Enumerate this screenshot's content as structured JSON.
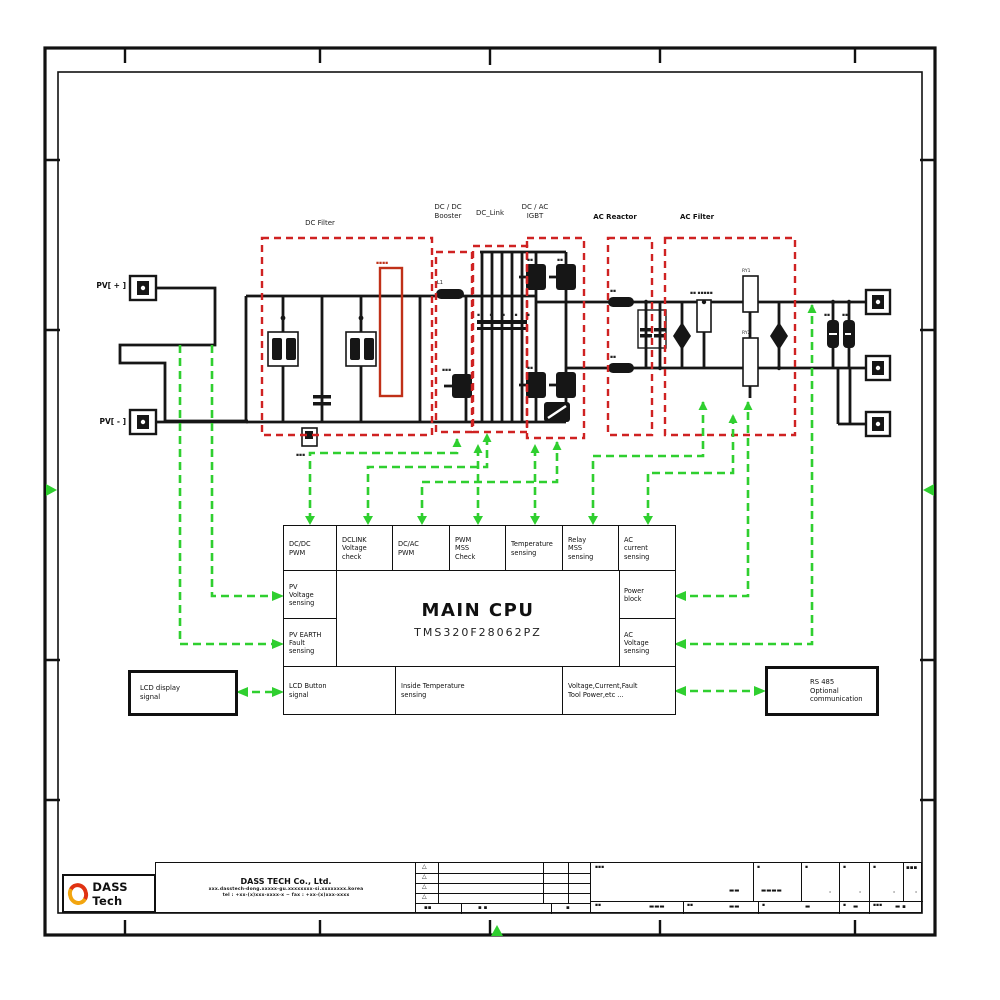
{
  "colors": {
    "wire_black": "#161616",
    "control_green": "#2fcf2f",
    "section_red": "#cf2222",
    "logo_red": "#e03212",
    "logo_orange": "#f2a50f"
  },
  "pv": {
    "plus": "PV[ + ]",
    "minus": "PV[ - ]"
  },
  "sec": {
    "dc_filter": "DC Filter",
    "booster": "DC / DC\nBooster",
    "dc_link": "DC_Link",
    "igbt": "DC / AC\nIGBT",
    "ac_reactor": "AC Reactor",
    "ac_filter": "AC Filter"
  },
  "cpu": {
    "title": "MAIN CPU",
    "part": "TMS320F28062PZ",
    "top": [
      "DC/DC\nPWM",
      "DCLINK\nVoltage\ncheck",
      "DC/AC\nPWM",
      "PWM\nMSS\nCheck",
      "Temperature\nsensing",
      "Relay\nMSS\nsensing",
      "AC\ncurrent\nsensing"
    ],
    "left": [
      "PV\nVoltage\nsensing",
      "PV EARTH\nFault\nsensing"
    ],
    "right": [
      "Power\nblock",
      "AC\nVoltage\nsensing"
    ],
    "bottom": [
      "LCD Button\nsignal",
      "Inside Temperature\nsensing",
      "Voltage,Current,Fault\nTool Power,etc ..."
    ]
  },
  "ext": {
    "lcd": "LCD display\nsignal",
    "rs485": "RS 485\nOptional\ncommunication"
  },
  "comp": {
    "l1": "L1",
    "ry1": "RY1",
    "ry2": "RY2",
    "red_mark": "▪▪▪▪",
    "caps_row": "▪ ▪ ▪ ▪ ▪",
    "film_label": "▪▪ ▪▪▪▪▪",
    "mark2": "▪▪",
    "mark3": "▪▪▪",
    "igbt_mark": "▪▪"
  },
  "tb": {
    "logo": "DASS Tech",
    "name": "DASS TECH Co., Ltd.",
    "addr": "xxx.dasstech-dong.xxxxx-gu.xxxxxxxx-si.xxxxxxxx.korea",
    "tel": "tel : +xx-(x)xxx-xxxx-x  ~  fax : +xx-(x)xxx-xxxx",
    "tri": "△",
    "foot": [
      "▪▪",
      "▪ ▪",
      "▪"
    ],
    "r1": [
      {
        "k": "▪▪▪",
        "v": "▬▬"
      },
      {
        "k": "▪",
        "v": "▬▬▬▬"
      },
      {
        "k": "▪",
        "v": "·"
      },
      {
        "k": "▪",
        "v": "·"
      },
      {
        "k": "▪",
        "v": "·"
      },
      {
        "k": "▪▪▪",
        "v": "·"
      }
    ],
    "r2": [
      {
        "k": "▪▪",
        "v": "▬▬▬"
      },
      {
        "k": "▪▪",
        "v": "▬▬"
      },
      {
        "k": "▪",
        "v": "▬"
      },
      {
        "k": "▪",
        "v": "▬"
      },
      {
        "k": "▪▪▪",
        "v": "▬ ▪"
      }
    ]
  }
}
